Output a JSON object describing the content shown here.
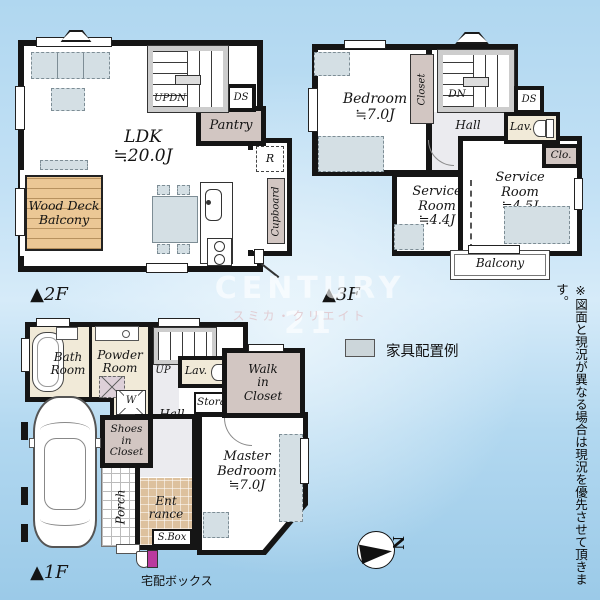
{
  "colors": {
    "wall": "#151515",
    "background_top": "#b0d7f0",
    "background_bottom": "#9bcae8",
    "cream_room": "#f1ead8",
    "closet_pink": "#d2c6c2",
    "furniture_gray": "#d4dfe4",
    "wood_deck_tan": "#ebc795",
    "entrance_tan": "#ddc19e",
    "delivery_box_accent": "#b93a9e"
  },
  "watermark": {
    "brand": "CENTURY 21",
    "company": "スミカ・クリエイト"
  },
  "legend": {
    "furniture": "家具配置例"
  },
  "note": {
    "disclaimer": "※図面と現況が異なる場合は現況を優先させて頂きます。"
  },
  "compass": {
    "north": "N"
  },
  "f2": {
    "floor": "▲2F",
    "ldk": "LDK\n≒20.0J",
    "wood_deck": "Wood Deck\nBalcony",
    "pantry": "Pantry",
    "ds": "DS",
    "fridge": "R",
    "cupboard": "Cupboard",
    "stairs": "UPDN"
  },
  "f3": {
    "floor": "▲3F",
    "bedroom": "Bedroom\n≒7.0J",
    "closet": "Closet",
    "stairs": "DN",
    "hall": "Hall",
    "ds": "DS",
    "lav": "Lav.",
    "clo": "Clo.",
    "service_a": "Service\nRoom\n≒4.4J",
    "service_b": "Service\nRoom\n≒4.5J",
    "balcony": "Balcony"
  },
  "f1": {
    "floor": "▲1F",
    "bath": "Bath\nRoom",
    "powder": "Powder\nRoom",
    "stairs": "UP",
    "lav": "Lav.",
    "washer": "W",
    "wic": "Walk\nin\nCloset",
    "storage": "Storage",
    "hall": "Hall",
    "shoes": "Shoes\nin\nCloset",
    "porch": "Porch",
    "entrance": "Ent\nrance",
    "sbox": "S.Box",
    "master": "Master\nBedroom\n≒7.0J",
    "delivery": "宅配ボックス"
  }
}
